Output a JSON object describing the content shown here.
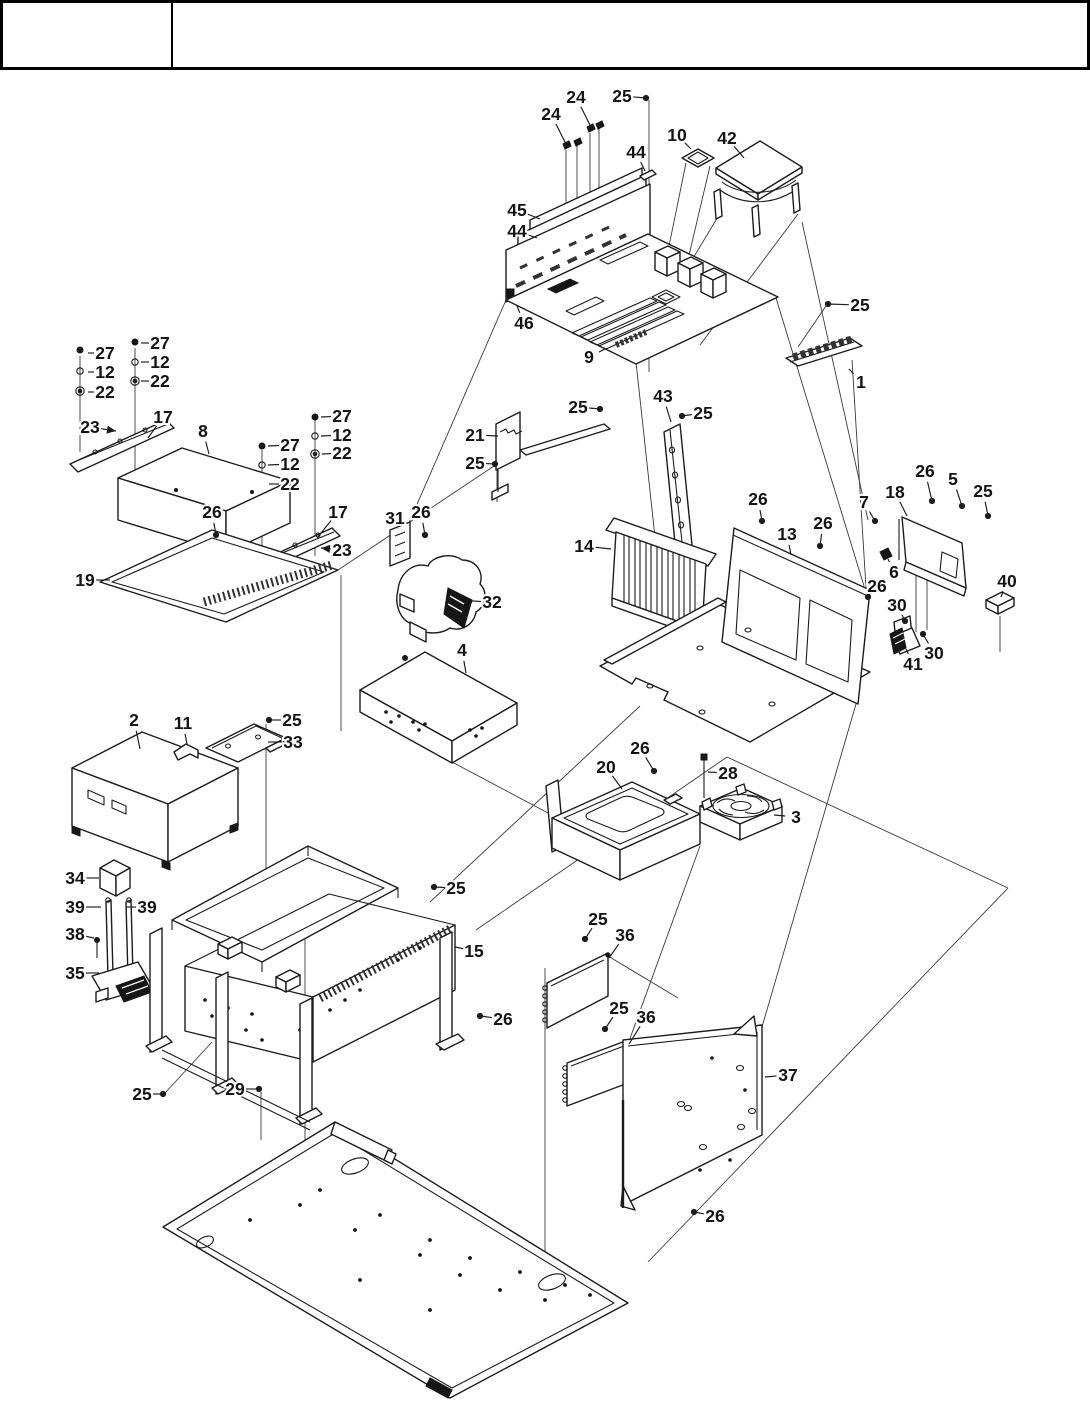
{
  "title_block": {
    "left_cell": "",
    "right_cell": ""
  },
  "figure": {
    "type": "exploded-parts-diagram",
    "subject": "computer chassis assembly with motherboard, heatsink, drives, fans, power supply and panels",
    "ink": "#1c1c1c",
    "page_bg": "#ffffff",
    "label_font_px": 17.5
  },
  "diagram": {
    "callouts": [
      {
        "n": "24",
        "x": 576,
        "y": 97,
        "tx": 592,
        "ty": 129,
        "m": "none"
      },
      {
        "n": "24",
        "x": 551,
        "y": 114,
        "tx": 567,
        "ty": 146,
        "m": "none"
      },
      {
        "n": "25",
        "x": 622,
        "y": 96,
        "tx": 646,
        "ty": 98,
        "m": "dot"
      },
      {
        "n": "44",
        "x": 636,
        "y": 152,
        "tx": 645,
        "ty": 171,
        "m": "none"
      },
      {
        "n": "10",
        "x": 677,
        "y": 135,
        "tx": 691,
        "ty": 149,
        "m": "none"
      },
      {
        "n": "42",
        "x": 727,
        "y": 138,
        "tx": 744,
        "ty": 158,
        "m": "none"
      },
      {
        "n": "45",
        "x": 517,
        "y": 210,
        "tx": 540,
        "ty": 219,
        "m": "none"
      },
      {
        "n": "44",
        "x": 517,
        "y": 231,
        "tx": 537,
        "ty": 238,
        "m": "none"
      },
      {
        "n": "46",
        "x": 524,
        "y": 323,
        "tx": 517,
        "ty": 306,
        "m": "none"
      },
      {
        "n": "9",
        "x": 589,
        "y": 357,
        "tx": 605,
        "ty": 349,
        "m": "none"
      },
      {
        "n": "25",
        "x": 860,
        "y": 305,
        "tx": 828,
        "ty": 304,
        "m": "dot"
      },
      {
        "n": "1",
        "x": 861,
        "y": 382,
        "tx": 849,
        "ty": 369,
        "m": "none"
      },
      {
        "n": "25",
        "x": 578,
        "y": 407,
        "tx": 600,
        "ty": 409,
        "m": "dot"
      },
      {
        "n": "43",
        "x": 663,
        "y": 396,
        "tx": 671,
        "ty": 422,
        "m": "none"
      },
      {
        "n": "25",
        "x": 703,
        "y": 413,
        "tx": 682,
        "ty": 416,
        "m": "dot"
      },
      {
        "n": "21",
        "x": 475,
        "y": 435,
        "tx": 498,
        "ty": 436,
        "m": "none"
      },
      {
        "n": "25",
        "x": 475,
        "y": 463,
        "tx": 495,
        "ty": 464,
        "m": "dot"
      },
      {
        "n": "14",
        "x": 584,
        "y": 546,
        "tx": 611,
        "ty": 549,
        "m": "none"
      },
      {
        "n": "26",
        "x": 758,
        "y": 499,
        "tx": 762,
        "ty": 521,
        "m": "dot"
      },
      {
        "n": "13",
        "x": 787,
        "y": 534,
        "tx": 791,
        "ty": 555,
        "m": "none"
      },
      {
        "n": "26",
        "x": 823,
        "y": 523,
        "tx": 820,
        "ty": 546,
        "m": "dot"
      },
      {
        "n": "7",
        "x": 864,
        "y": 502,
        "tx": 875,
        "ty": 521,
        "m": "dot"
      },
      {
        "n": "18",
        "x": 895,
        "y": 492,
        "tx": 907,
        "ty": 516,
        "m": "none"
      },
      {
        "n": "26",
        "x": 925,
        "y": 471,
        "tx": 932,
        "ty": 501,
        "m": "dot"
      },
      {
        "n": "5",
        "x": 953,
        "y": 479,
        "tx": 962,
        "ty": 506,
        "m": "dot"
      },
      {
        "n": "25",
        "x": 983,
        "y": 491,
        "tx": 988,
        "ty": 516,
        "m": "dot"
      },
      {
        "n": "6",
        "x": 894,
        "y": 572,
        "tx": 888,
        "ty": 559,
        "m": "none"
      },
      {
        "n": "26",
        "x": 877,
        "y": 586,
        "tx": 868,
        "ty": 597,
        "m": "dot"
      },
      {
        "n": "40",
        "x": 1007,
        "y": 581,
        "tx": 1001,
        "ty": 597,
        "m": "none"
      },
      {
        "n": "30",
        "x": 897,
        "y": 605,
        "tx": 905,
        "ty": 621,
        "m": "dot"
      },
      {
        "n": "41",
        "x": 913,
        "y": 664,
        "tx": 906,
        "ty": 649,
        "m": "none"
      },
      {
        "n": "30",
        "x": 934,
        "y": 653,
        "tx": 923,
        "ty": 634,
        "m": "dot"
      },
      {
        "n": "27",
        "x": 160,
        "y": 343,
        "tx": 141,
        "ty": 343,
        "m": "none"
      },
      {
        "n": "27",
        "x": 105,
        "y": 353,
        "tx": 88,
        "ty": 353,
        "m": "none"
      },
      {
        "n": "12",
        "x": 160,
        "y": 362,
        "tx": 141,
        "ty": 362,
        "m": "none"
      },
      {
        "n": "12",
        "x": 105,
        "y": 372,
        "tx": 88,
        "ty": 372,
        "m": "none"
      },
      {
        "n": "22",
        "x": 160,
        "y": 381,
        "tx": 141,
        "ty": 381,
        "m": "none"
      },
      {
        "n": "22",
        "x": 105,
        "y": 392,
        "tx": 88,
        "ty": 392,
        "m": "none"
      },
      {
        "n": "23",
        "x": 90,
        "y": 427,
        "tx": 116,
        "ty": 431,
        "m": "arrow"
      },
      {
        "n": "17",
        "x": 163,
        "y": 417,
        "tx": 148,
        "ty": 438,
        "m": "none"
      },
      {
        "n": "8",
        "x": 203,
        "y": 431,
        "tx": 209,
        "ty": 454,
        "m": "none"
      },
      {
        "n": "27",
        "x": 290,
        "y": 445,
        "tx": 268,
        "ty": 446,
        "m": "none"
      },
      {
        "n": "12",
        "x": 290,
        "y": 464,
        "tx": 268,
        "ty": 465,
        "m": "none"
      },
      {
        "n": "22",
        "x": 290,
        "y": 484,
        "tx": 269,
        "ty": 484,
        "m": "none"
      },
      {
        "n": "27",
        "x": 342,
        "y": 416,
        "tx": 321,
        "ty": 417,
        "m": "none"
      },
      {
        "n": "12",
        "x": 342,
        "y": 435,
        "tx": 321,
        "ty": 436,
        "m": "none"
      },
      {
        "n": "22",
        "x": 342,
        "y": 453,
        "tx": 322,
        "ty": 454,
        "m": "none"
      },
      {
        "n": "17",
        "x": 338,
        "y": 512,
        "tx": 317,
        "ty": 538,
        "m": "none"
      },
      {
        "n": "23",
        "x": 342,
        "y": 550,
        "tx": 321,
        "ty": 548,
        "m": "arrow"
      },
      {
        "n": "26",
        "x": 212,
        "y": 512,
        "tx": 216,
        "ty": 535,
        "m": "dot"
      },
      {
        "n": "19",
        "x": 85,
        "y": 580,
        "tx": 110,
        "ty": 580,
        "m": "none"
      },
      {
        "n": "31",
        "x": 395,
        "y": 518,
        "tx": 398,
        "ty": 529,
        "m": "none"
      },
      {
        "n": "26",
        "x": 421,
        "y": 512,
        "tx": 425,
        "ty": 535,
        "m": "dot"
      },
      {
        "n": "32",
        "x": 492,
        "y": 602,
        "tx": 472,
        "ty": 601,
        "m": "none"
      },
      {
        "n": "4",
        "x": 462,
        "y": 650,
        "tx": 466,
        "ty": 673,
        "m": "none"
      },
      {
        "n": "2",
        "x": 134,
        "y": 720,
        "tx": 140,
        "ty": 749,
        "m": "none"
      },
      {
        "n": "11",
        "x": 183,
        "y": 723,
        "tx": 187,
        "ty": 744,
        "m": "none"
      },
      {
        "n": "25",
        "x": 292,
        "y": 720,
        "tx": 269,
        "ty": 720,
        "m": "dot"
      },
      {
        "n": "33",
        "x": 293,
        "y": 742,
        "tx": 268,
        "ty": 742,
        "m": "none"
      },
      {
        "n": "34",
        "x": 75,
        "y": 878,
        "tx": 99,
        "ty": 878,
        "m": "none"
      },
      {
        "n": "39",
        "x": 75,
        "y": 907,
        "tx": 101,
        "ty": 907,
        "m": "none"
      },
      {
        "n": "39",
        "x": 147,
        "y": 907,
        "tx": 126,
        "ty": 907,
        "m": "none"
      },
      {
        "n": "38",
        "x": 75,
        "y": 934,
        "tx": 94,
        "ty": 938,
        "m": "none"
      },
      {
        "n": "35",
        "x": 75,
        "y": 973,
        "tx": 99,
        "ty": 973,
        "m": "none"
      },
      {
        "n": "20",
        "x": 606,
        "y": 767,
        "tx": 622,
        "ty": 789,
        "m": "none"
      },
      {
        "n": "26",
        "x": 640,
        "y": 748,
        "tx": 654,
        "ty": 771,
        "m": "dot"
      },
      {
        "n": "28",
        "x": 728,
        "y": 773,
        "tx": 708,
        "ty": 772,
        "m": "none"
      },
      {
        "n": "3",
        "x": 796,
        "y": 817,
        "tx": 774,
        "ty": 815,
        "m": "none"
      },
      {
        "n": "25",
        "x": 598,
        "y": 919,
        "tx": 585,
        "ty": 939,
        "m": "dot"
      },
      {
        "n": "36",
        "x": 625,
        "y": 935,
        "tx": 609,
        "ty": 958,
        "m": "none"
      },
      {
        "n": "15",
        "x": 474,
        "y": 951,
        "tx": 455,
        "ty": 947,
        "m": "none"
      },
      {
        "n": "26",
        "x": 503,
        "y": 1019,
        "tx": 480,
        "ty": 1016,
        "m": "dot"
      },
      {
        "n": "25",
        "x": 456,
        "y": 888,
        "tx": 434,
        "ty": 887,
        "m": "dot"
      },
      {
        "n": "25",
        "x": 142,
        "y": 1094,
        "tx": 163,
        "ty": 1094,
        "m": "dot"
      },
      {
        "n": "29",
        "x": 235,
        "y": 1089,
        "tx": 259,
        "ty": 1089,
        "m": "dot"
      },
      {
        "n": "25",
        "x": 619,
        "y": 1008,
        "tx": 605,
        "ty": 1029,
        "m": "dot"
      },
      {
        "n": "36",
        "x": 646,
        "y": 1017,
        "tx": 629,
        "ty": 1044,
        "m": "none"
      },
      {
        "n": "37",
        "x": 788,
        "y": 1075,
        "tx": 765,
        "ty": 1077,
        "m": "none"
      },
      {
        "n": "26",
        "x": 715,
        "y": 1216,
        "tx": 694,
        "ty": 1212,
        "m": "dot"
      }
    ]
  }
}
